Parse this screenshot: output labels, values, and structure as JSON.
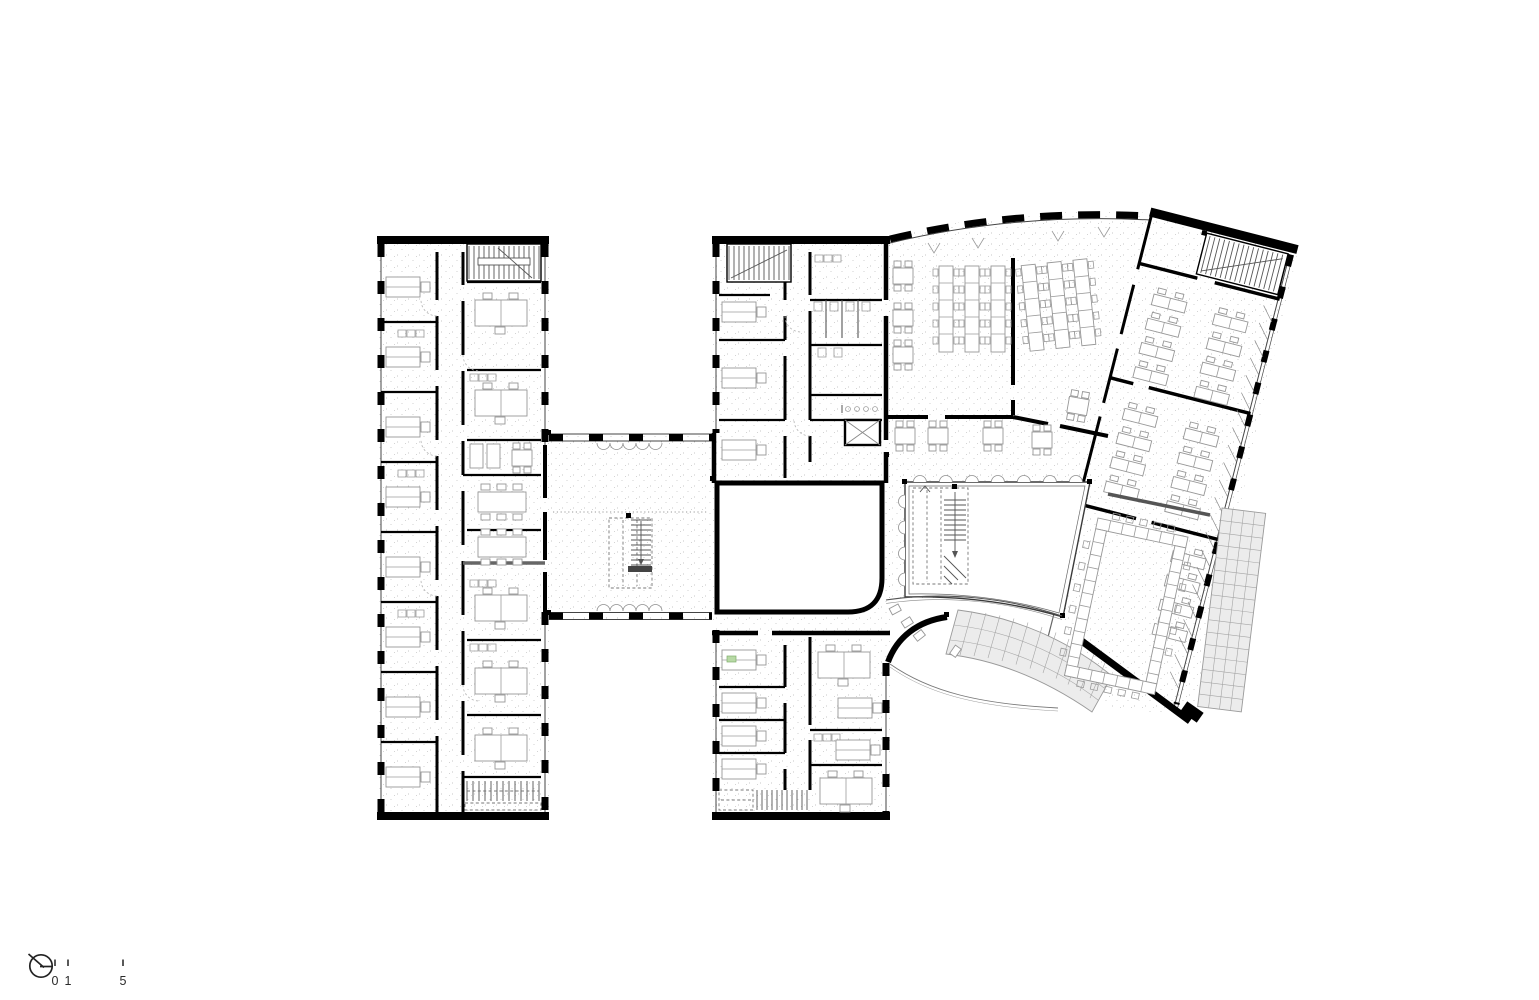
{
  "plan": {
    "type": "architectural-floor-plan",
    "scale_bar": {
      "labels": [
        "0",
        "1",
        "5"
      ]
    },
    "colors": {
      "walls": "#000000",
      "furniture_lines": "#979797",
      "floor_stipple": "#b9b9b9",
      "louver_band_fill": "#ececec",
      "accent_green": "#b7d9a5",
      "background": "#ffffff"
    }
  }
}
